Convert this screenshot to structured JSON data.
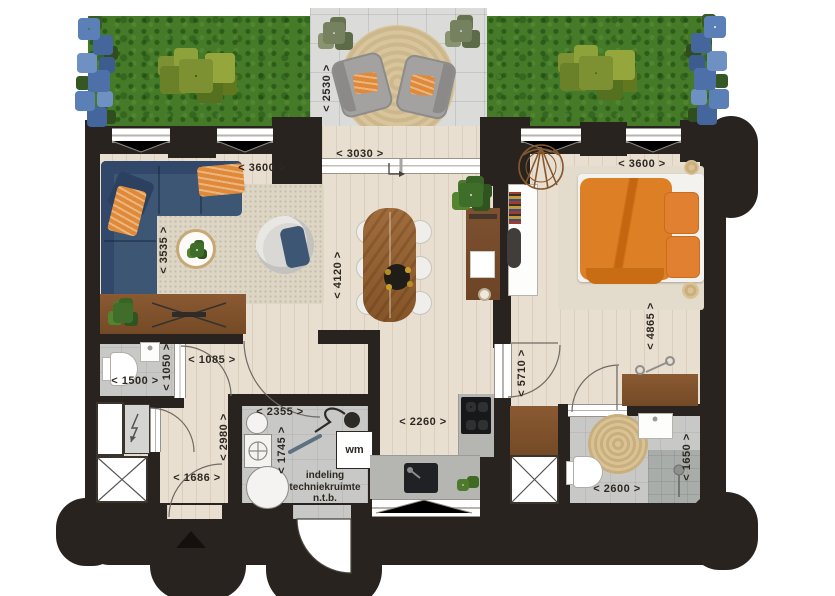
{
  "dims": {
    "terrace_depth": "< 2530 >",
    "terrace_width": "< 3030 >",
    "living_width": "< 3600 >",
    "living_depth": "< 3535 >",
    "dining_length": "< 4120 >",
    "bedroom_width": "< 3600 >",
    "bedroom_length": "< 4865 >",
    "bedroom_hall": "< 5710 >",
    "wc_width": "< 1500 >",
    "wc_depth": "< 1050 >",
    "hall_width": "< 1085 >",
    "hall_length": "< 2980 >",
    "entry_width": "< 1686 >",
    "tech_width": "< 2355 >",
    "tech_depth": "< 1745 >",
    "kitchen_width": "< 2260 >",
    "bath_width": "< 2600 >",
    "bath_depth": "< 1650 >"
  },
  "labels": {
    "washing_machine": "wm",
    "tech_note": "indeling techniekruimte n.t.b."
  },
  "colors": {
    "wall": "#29231f",
    "floor_wood": "#e9dfd0",
    "floor_gray": "#c8c9c6",
    "terrace_tile": "#dbdbd9",
    "grass": "#447a28",
    "sofa_blue": "#3d5674",
    "accent_orange": "#df8a3a",
    "bed_orange": "#dd7f24",
    "furniture_wood": "#8a5a32",
    "rug": "#ded6c4"
  }
}
